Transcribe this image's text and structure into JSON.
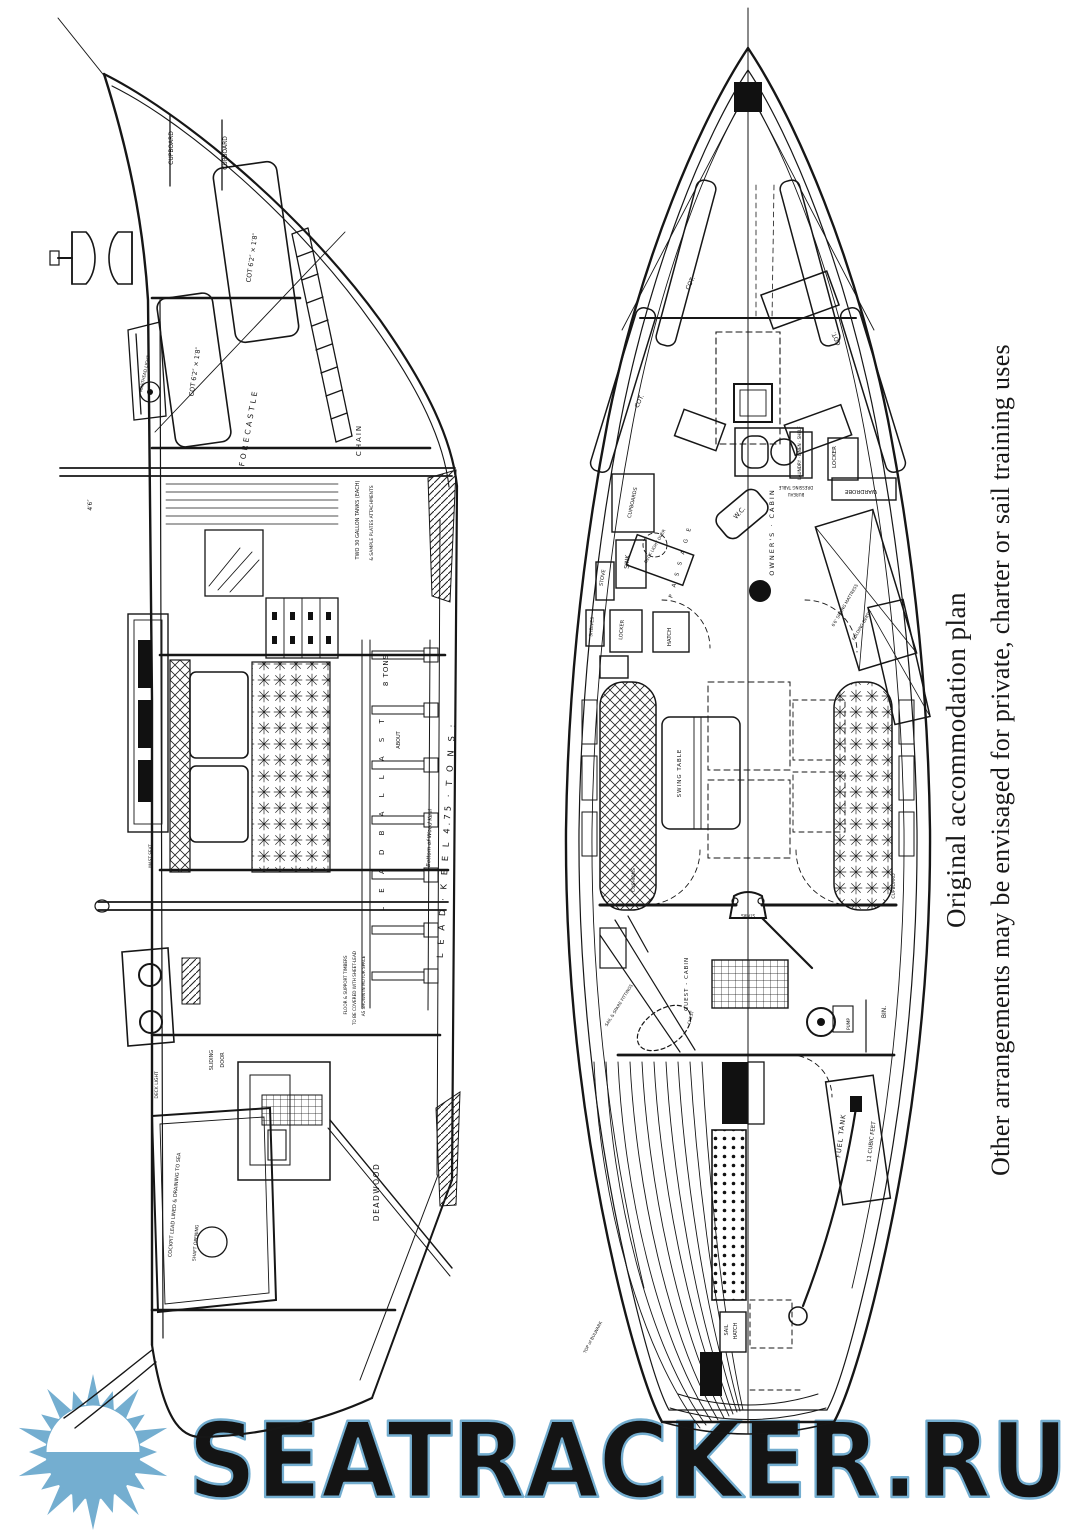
{
  "caption": {
    "line1": "Original accommodation plan",
    "line2": "Other arrangements may be envisaged for private, charter or sail training uses"
  },
  "watermark": {
    "text": "SEATRACKER.RU",
    "color": "#74aed0"
  },
  "profile_view": {
    "labels": [
      {
        "text": "CUPBOARD",
        "x": 173,
        "y": 148,
        "size": 6,
        "rot": -90
      },
      {
        "text": "CUPBOARD",
        "x": 227,
        "y": 153,
        "size": 6,
        "rot": -90
      },
      {
        "text": "COT 6′2″ × 1′8″",
        "x": 254,
        "y": 258,
        "size": 6.5,
        "rot": -82
      },
      {
        "text": "COT 6′2″ × 1′8″",
        "x": 197,
        "y": 372,
        "size": 6.5,
        "rot": -82
      },
      {
        "text": "FORECASTLE",
        "x": 251,
        "y": 428,
        "size": 7.5,
        "rot": -80,
        "ls": 3
      },
      {
        "text": "CHAIN",
        "x": 361,
        "y": 440,
        "size": 7,
        "rot": -90,
        "ls": 2
      },
      {
        "text": "TWO 30 GALLON TANKS (EACH)",
        "x": 359,
        "y": 520,
        "size": 5,
        "rot": -90
      },
      {
        "text": "& SAMPLE PLATES ATTACHMENTS",
        "x": 373,
        "y": 523,
        "size": 4.5,
        "rot": -90
      },
      {
        "text": "8 TONS",
        "x": 388,
        "y": 670,
        "size": 7,
        "rot": -90,
        "ls": 1
      },
      {
        "text": "ABOUT",
        "x": 400,
        "y": 740,
        "size": 5,
        "rot": -90
      },
      {
        "text": "L E A D   B A L L A S T",
        "x": 384,
        "y": 812,
        "size": 7,
        "rot": -90,
        "ls": 6
      },
      {
        "text": "Bottom of Wood Keel",
        "x": 431,
        "y": 838,
        "size": 5.5,
        "rot": -88,
        "italic": true
      },
      {
        "text": "L E A D · K E E L   4.75 · T O N S :",
        "x": 449,
        "y": 840,
        "size": 8.5,
        "rot": -87,
        "ls": 3
      },
      {
        "text": "DEADWOOD",
        "x": 379,
        "y": 1192,
        "size": 7.5,
        "rot": -90,
        "ls": 1.5
      },
      {
        "text": "SLIDING",
        "x": 213,
        "y": 1060,
        "size": 5,
        "rot": -90
      },
      {
        "text": "DOOR",
        "x": 224,
        "y": 1060,
        "size": 5,
        "rot": -90
      },
      {
        "text": "COCKPIT LEAD LINED & DRAINING TO SEA",
        "x": 176,
        "y": 1205,
        "size": 5,
        "rot": -85
      },
      {
        "text": "SHAFT OPENING",
        "x": 197,
        "y": 1243,
        "size": 4.5,
        "rot": -85
      },
      {
        "text": "FLOOR & SUPPORT TIMBERS",
        "x": 347,
        "y": 985,
        "size": 4.2,
        "rot": -90
      },
      {
        "text": "TO BE COVERED WITH SHEET-LEAD",
        "x": 356,
        "y": 988,
        "size": 4.2,
        "rot": -90
      },
      {
        "text": "AS SHOWN IN MOTOR SPACE",
        "x": 365,
        "y": 986,
        "size": 4.2,
        "rot": -90
      },
      {
        "text": "DECK LIGHT",
        "x": 158,
        "y": 1085,
        "size": 4.5,
        "rot": -90
      },
      {
        "text": "4′6″",
        "x": 92,
        "y": 505,
        "size": 6,
        "rot": -90
      },
      {
        "text": "MAST SEAT",
        "x": 152,
        "y": 856,
        "size": 4.2,
        "rot": -90
      },
      {
        "text": "MASTHEAD LIGHT",
        "x": 146,
        "y": 374,
        "size": 4.2,
        "rot": -78
      }
    ]
  },
  "plan_view": {
    "labels": [
      {
        "text": "COT.",
        "x": 692,
        "y": 284,
        "size": 6,
        "rot": -65
      },
      {
        "text": "COT.",
        "x": 641,
        "y": 402,
        "size": 6,
        "rot": -65
      },
      {
        "text": "COT.",
        "x": 838,
        "y": 338,
        "size": 6,
        "rot": -115
      },
      {
        "text": "CUPBOARDS",
        "x": 634,
        "y": 503,
        "size": 5,
        "rot": -78
      },
      {
        "text": "SINK",
        "x": 629,
        "y": 562,
        "size": 6,
        "rot": -85
      },
      {
        "text": "STOVE",
        "x": 604,
        "y": 578,
        "size": 5,
        "rot": -80
      },
      {
        "text": "LOCKER",
        "x": 623,
        "y": 630,
        "size": 5,
        "rot": -85
      },
      {
        "text": "SHELVES",
        "x": 593,
        "y": 627,
        "size": 4.5,
        "rot": -85
      },
      {
        "text": "HATCH",
        "x": 671,
        "y": 637,
        "size": 5.5,
        "rot": -90
      },
      {
        "text": "P A S S A G E",
        "x": 682,
        "y": 562,
        "size": 5.5,
        "rot": -75,
        "ls": 3
      },
      {
        "text": "DECK LIGHT OVER",
        "x": 656,
        "y": 547,
        "size": 4.2,
        "rot": -60
      },
      {
        "text": "W.C.",
        "x": 741,
        "y": 514,
        "size": 6.5,
        "rot": -48
      },
      {
        "text": "LAUNDRY · LINEN · SHELF",
        "x": 801,
        "y": 453,
        "size": 4.2,
        "rot": -90
      },
      {
        "text": "LOCKER",
        "x": 836,
        "y": 457,
        "size": 5.5,
        "rot": -90
      },
      {
        "text": "WARDROBE",
        "x": 861,
        "y": 490,
        "size": 5.5,
        "rot": 180
      },
      {
        "text": "OWNER'S · CABIN",
        "x": 774,
        "y": 532,
        "size": 6.5,
        "rot": -90,
        "ls": 2
      },
      {
        "text": "DRESSING TABLE",
        "x": 796,
        "y": 486,
        "size": 4,
        "rot": 180
      },
      {
        "text": "BUREAU",
        "x": 796,
        "y": 493,
        "size": 4,
        "rot": 180
      },
      {
        "text": "6′6″ SPRING MATTRESS",
        "x": 846,
        "y": 606,
        "size": 4.2,
        "rot": -60
      },
      {
        "text": "FOLDING BERTH",
        "x": 863,
        "y": 626,
        "size": 4.2,
        "rot": -60
      },
      {
        "text": "SWING TABLE",
        "x": 681,
        "y": 773,
        "size": 5.5,
        "rot": -90,
        "ls": 1
      },
      {
        "text": "CUSHIONS",
        "x": 635,
        "y": 880,
        "size": 4.5,
        "rot": -90
      },
      {
        "text": "CUPBOARD",
        "x": 895,
        "y": 886,
        "size": 4.5,
        "rot": -90
      },
      {
        "text": "GUEST - CABIN",
        "x": 688,
        "y": 984,
        "size": 5.5,
        "rot": -90,
        "ls": 1
      },
      {
        "text": "STAIRS",
        "x": 748,
        "y": 914,
        "size": 4,
        "rot": 180
      },
      {
        "text": "SAIL & SPARE FITTINGS",
        "x": 620,
        "y": 1006,
        "size": 4.2,
        "rot": -58
      },
      {
        "text": "CHEST",
        "x": 692,
        "y": 1018,
        "size": 4.2,
        "rot": -75
      },
      {
        "text": "BIN.",
        "x": 886,
        "y": 1012,
        "size": 6,
        "rot": -90
      },
      {
        "text": "PUMP",
        "x": 850,
        "y": 1024,
        "size": 4.2,
        "rot": -90
      },
      {
        "text": "FUEL TANK",
        "x": 843,
        "y": 1136,
        "size": 6.5,
        "rot": -83,
        "ls": 1
      },
      {
        "text": "11 CUBIC FEET",
        "x": 873,
        "y": 1142,
        "size": 5.5,
        "rot": -83
      },
      {
        "text": "SAIL",
        "x": 728,
        "y": 1330,
        "size": 5,
        "rot": -90
      },
      {
        "text": "HATCH",
        "x": 737,
        "y": 1331,
        "size": 5,
        "rot": -90
      },
      {
        "text": "TOP of BULWARK",
        "x": 594,
        "y": 1338,
        "size": 4.2,
        "rot": -62
      }
    ]
  }
}
